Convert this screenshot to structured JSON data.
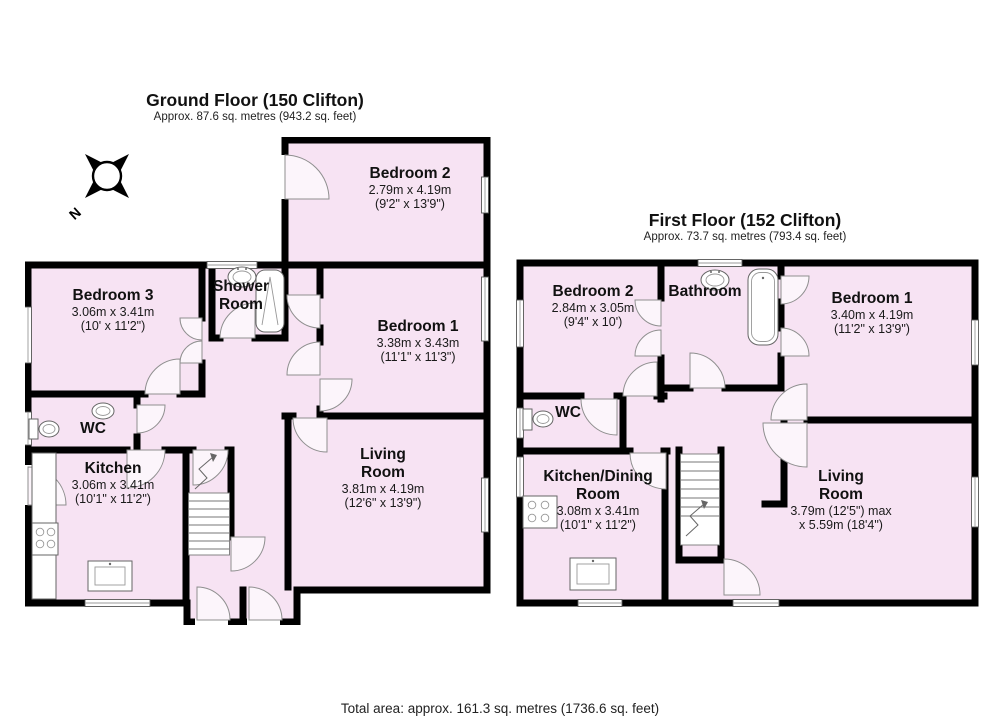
{
  "page": {
    "total_area": "Total area: approx. 161.3 sq. metres (1736.6 sq. feet)"
  },
  "colors": {
    "room_fill": "#f7e3f3",
    "wall": "#000000"
  },
  "compass": {
    "label": "N"
  },
  "ground_floor": {
    "title": "Ground Floor (150 Clifton)",
    "subtitle": "Approx. 87.6 sq. metres (943.2 sq. feet)",
    "rooms": [
      {
        "name": "Bedroom 2",
        "dims1": "2.79m x 4.19m",
        "dims2": "(9'2\" x 13'9\")"
      },
      {
        "name": "Bedroom 3",
        "dims1": "3.06m x 3.41m",
        "dims2": "(10' x 11'2\")"
      },
      {
        "name": "Shower Room"
      },
      {
        "name": "Bedroom 1",
        "dims1": "3.38m x 3.43m",
        "dims2": "(11'1\" x 11'3\")"
      },
      {
        "name": "WC"
      },
      {
        "name": "Kitchen",
        "dims1": "3.06m x 3.41m",
        "dims2": "(10'1\" x 11'2\")"
      },
      {
        "name": "Living Room",
        "dims1": "3.81m x 4.19m",
        "dims2": "(12'6\" x 13'9\")"
      }
    ]
  },
  "first_floor": {
    "title": "First Floor (152 Clifton)",
    "subtitle": "Approx. 73.7 sq. metres (793.4 sq. feet)",
    "rooms": [
      {
        "name": "Bedroom 2",
        "dims1": "2.84m x 3.05m",
        "dims2": "(9'4\" x 10')"
      },
      {
        "name": "Bathroom"
      },
      {
        "name": "Bedroom 1",
        "dims1": "3.40m x 4.19m",
        "dims2": "(11'2\" x 13'9\")"
      },
      {
        "name": "WC"
      },
      {
        "name": "Kitchen/Dining Room",
        "dims1": "3.08m x 3.41m",
        "dims2": "(10'1\" x 11'2\")"
      },
      {
        "name": "Living Room",
        "dims1": "3.79m (12'5\") max",
        "dims2": "x 5.59m (18'4\")"
      }
    ]
  }
}
